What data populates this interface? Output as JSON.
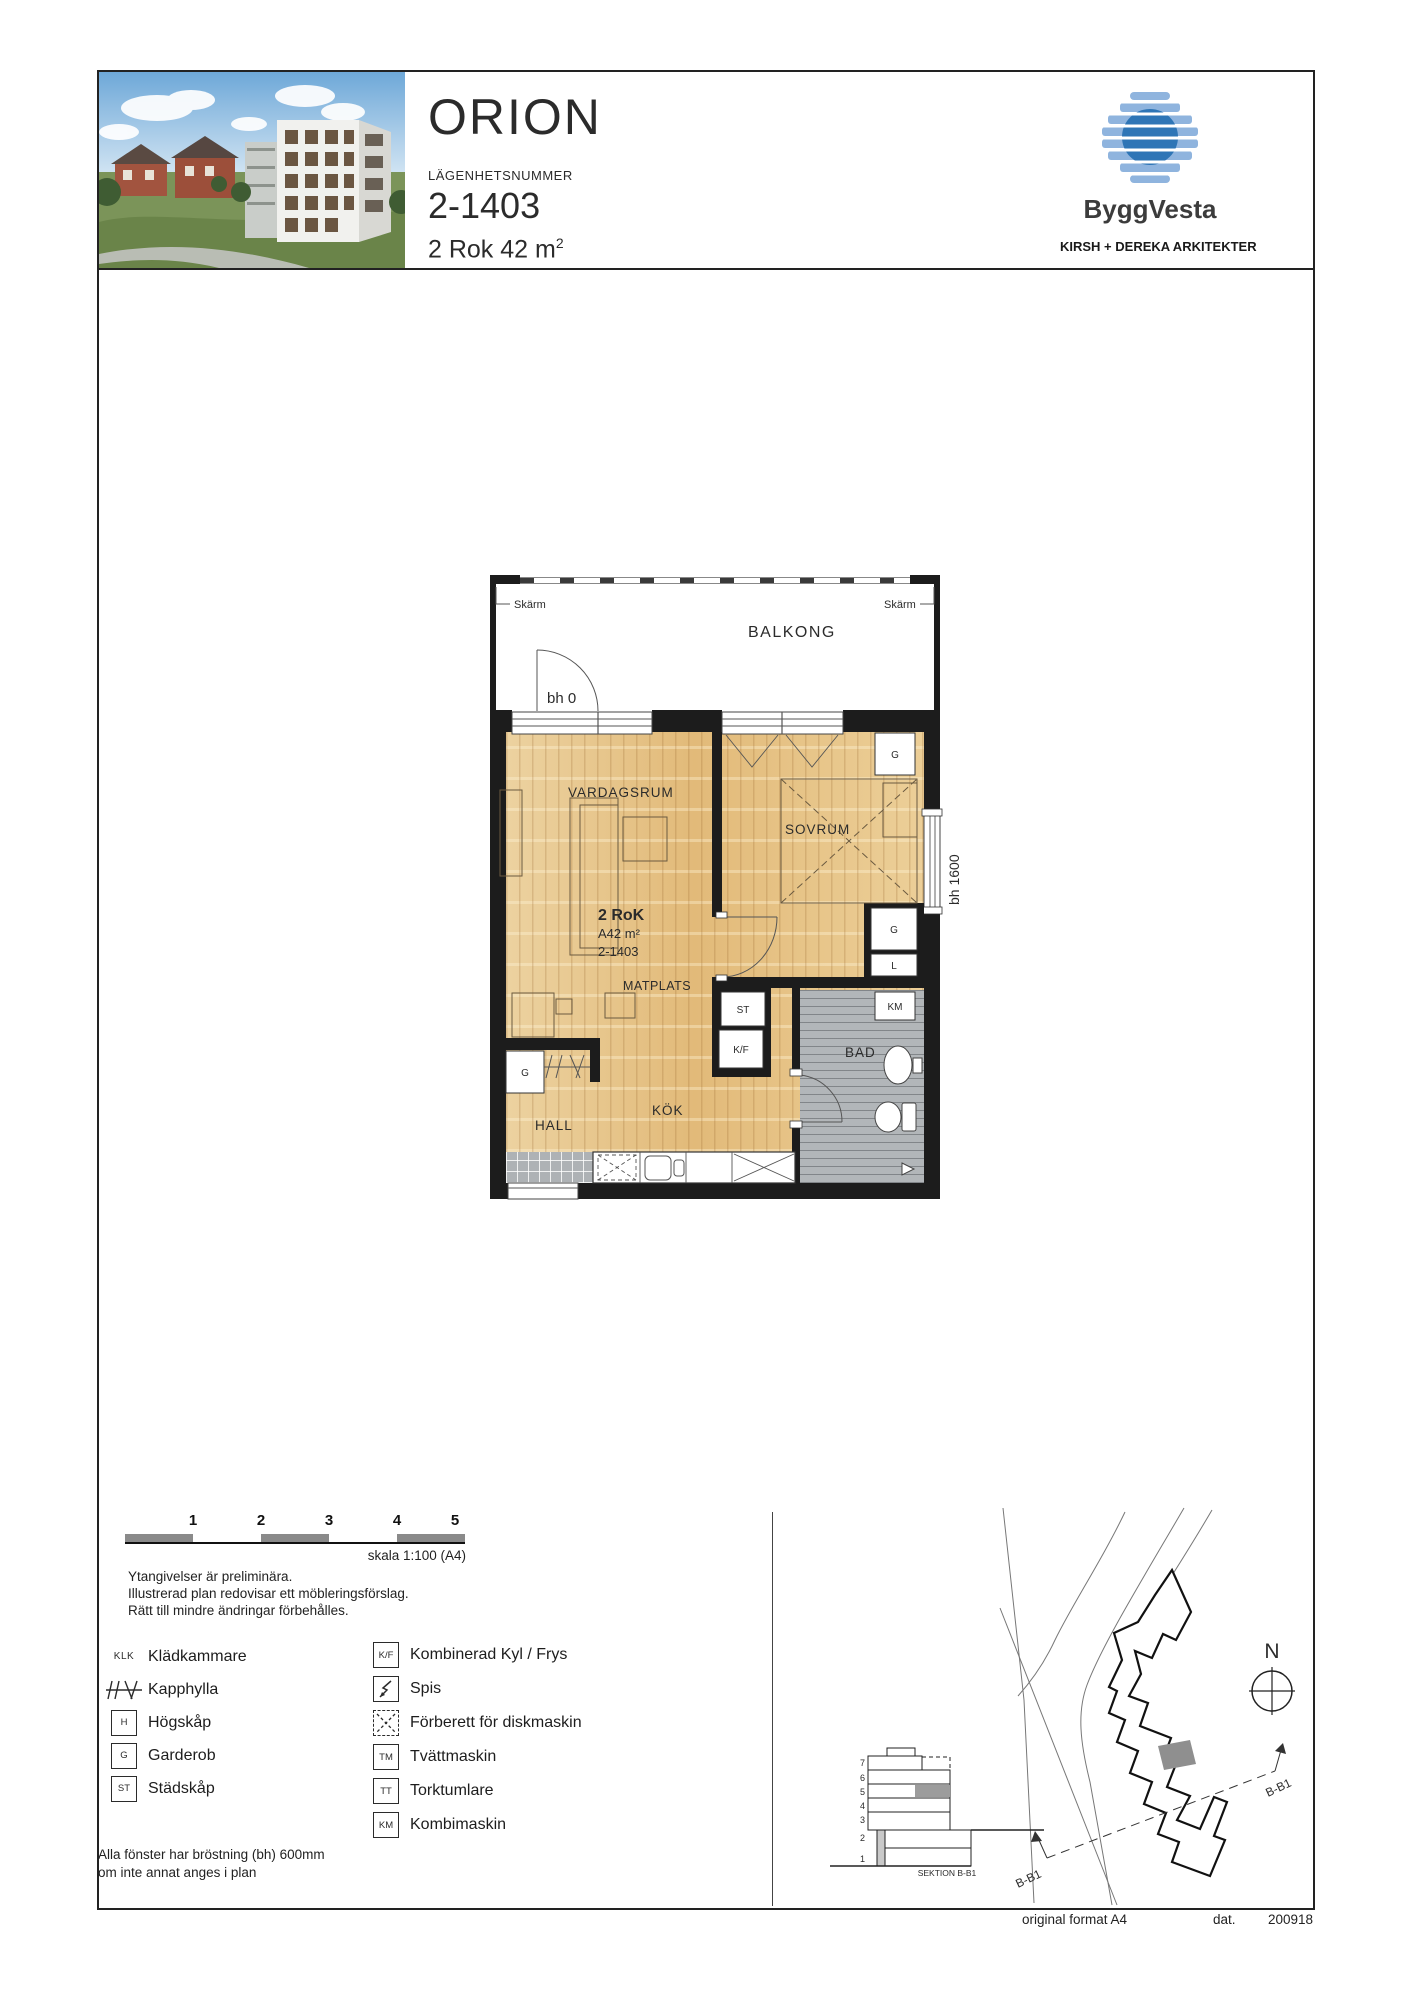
{
  "header": {
    "project": "ORION",
    "apartment_number_label": "LÄGENHETSNUMMER",
    "apartment_number": "2-1403",
    "size": "2 Rok 42 m",
    "size_sup": "2",
    "brand": "ByggVesta",
    "architect": "KIRSH + DEREKA ARKITEKTER"
  },
  "plan": {
    "balcony": "BALKONG",
    "screen_left": "Skärm",
    "screen_right": "Skärm",
    "balcony_sill": "bh 0",
    "window_sill": "bh 1600",
    "rooms": {
      "living": "VARDAGSRUM",
      "bedroom": "SOVRUM",
      "dining": "MATPLATS",
      "kitchen": "KÖK",
      "hall": "HALL",
      "bath": "BAD"
    },
    "unit": {
      "type": "2 RoK",
      "area": "A42 m²",
      "number": "2-1403"
    },
    "closets": {
      "g": "G",
      "l": "L",
      "st": "ST",
      "kf": "K/F",
      "km": "KM"
    }
  },
  "scalebar": {
    "ticks": [
      "1",
      "2",
      "3",
      "4",
      "5"
    ],
    "label": "skala 1:100 (A4)"
  },
  "notes": [
    "Ytangivelser är preliminära.",
    "Illustrerad plan redovisar ett möbleringsförslag.",
    "Rätt till mindre ändringar förbehålles."
  ],
  "legend": {
    "left": [
      {
        "symbol": "KLK",
        "label": "Klädkammare"
      },
      {
        "symbol": "",
        "label": "Kapphylla"
      },
      {
        "symbol": "H",
        "label": "Högskåp"
      },
      {
        "symbol": "G",
        "label": "Garderob"
      },
      {
        "symbol": "ST",
        "label": "Städskåp"
      }
    ],
    "right": [
      {
        "symbol": "K/F",
        "label": "Kombinerad Kyl / Frys"
      },
      {
        "symbol": "",
        "label": "Spis"
      },
      {
        "symbol": "",
        "label": "Förberett för diskmaskin"
      },
      {
        "symbol": "TM",
        "label": "Tvättmaskin"
      },
      {
        "symbol": "TT",
        "label": "Torktumlare"
      },
      {
        "symbol": "KM",
        "label": "Kombimaskin"
      }
    ]
  },
  "window_note": [
    "Alla fönster har bröstning (bh) 600mm",
    "om inte annat anges i plan"
  ],
  "siteplan": {
    "north": "N",
    "section_title": "SEKTION B-B1",
    "section_line_label": "B-B1",
    "floors": [
      "7",
      "6",
      "5",
      "4",
      "3",
      "2",
      "1"
    ]
  },
  "footer": {
    "format": "original format A4",
    "dat_label": "dat.",
    "date": "200918"
  },
  "colors": {
    "wood": "#e4bf80",
    "tile": "#b2b6b9",
    "wall": "#1c1c1c",
    "brand_blue": "#2e75b6",
    "brand_light": "#8fb4de"
  }
}
